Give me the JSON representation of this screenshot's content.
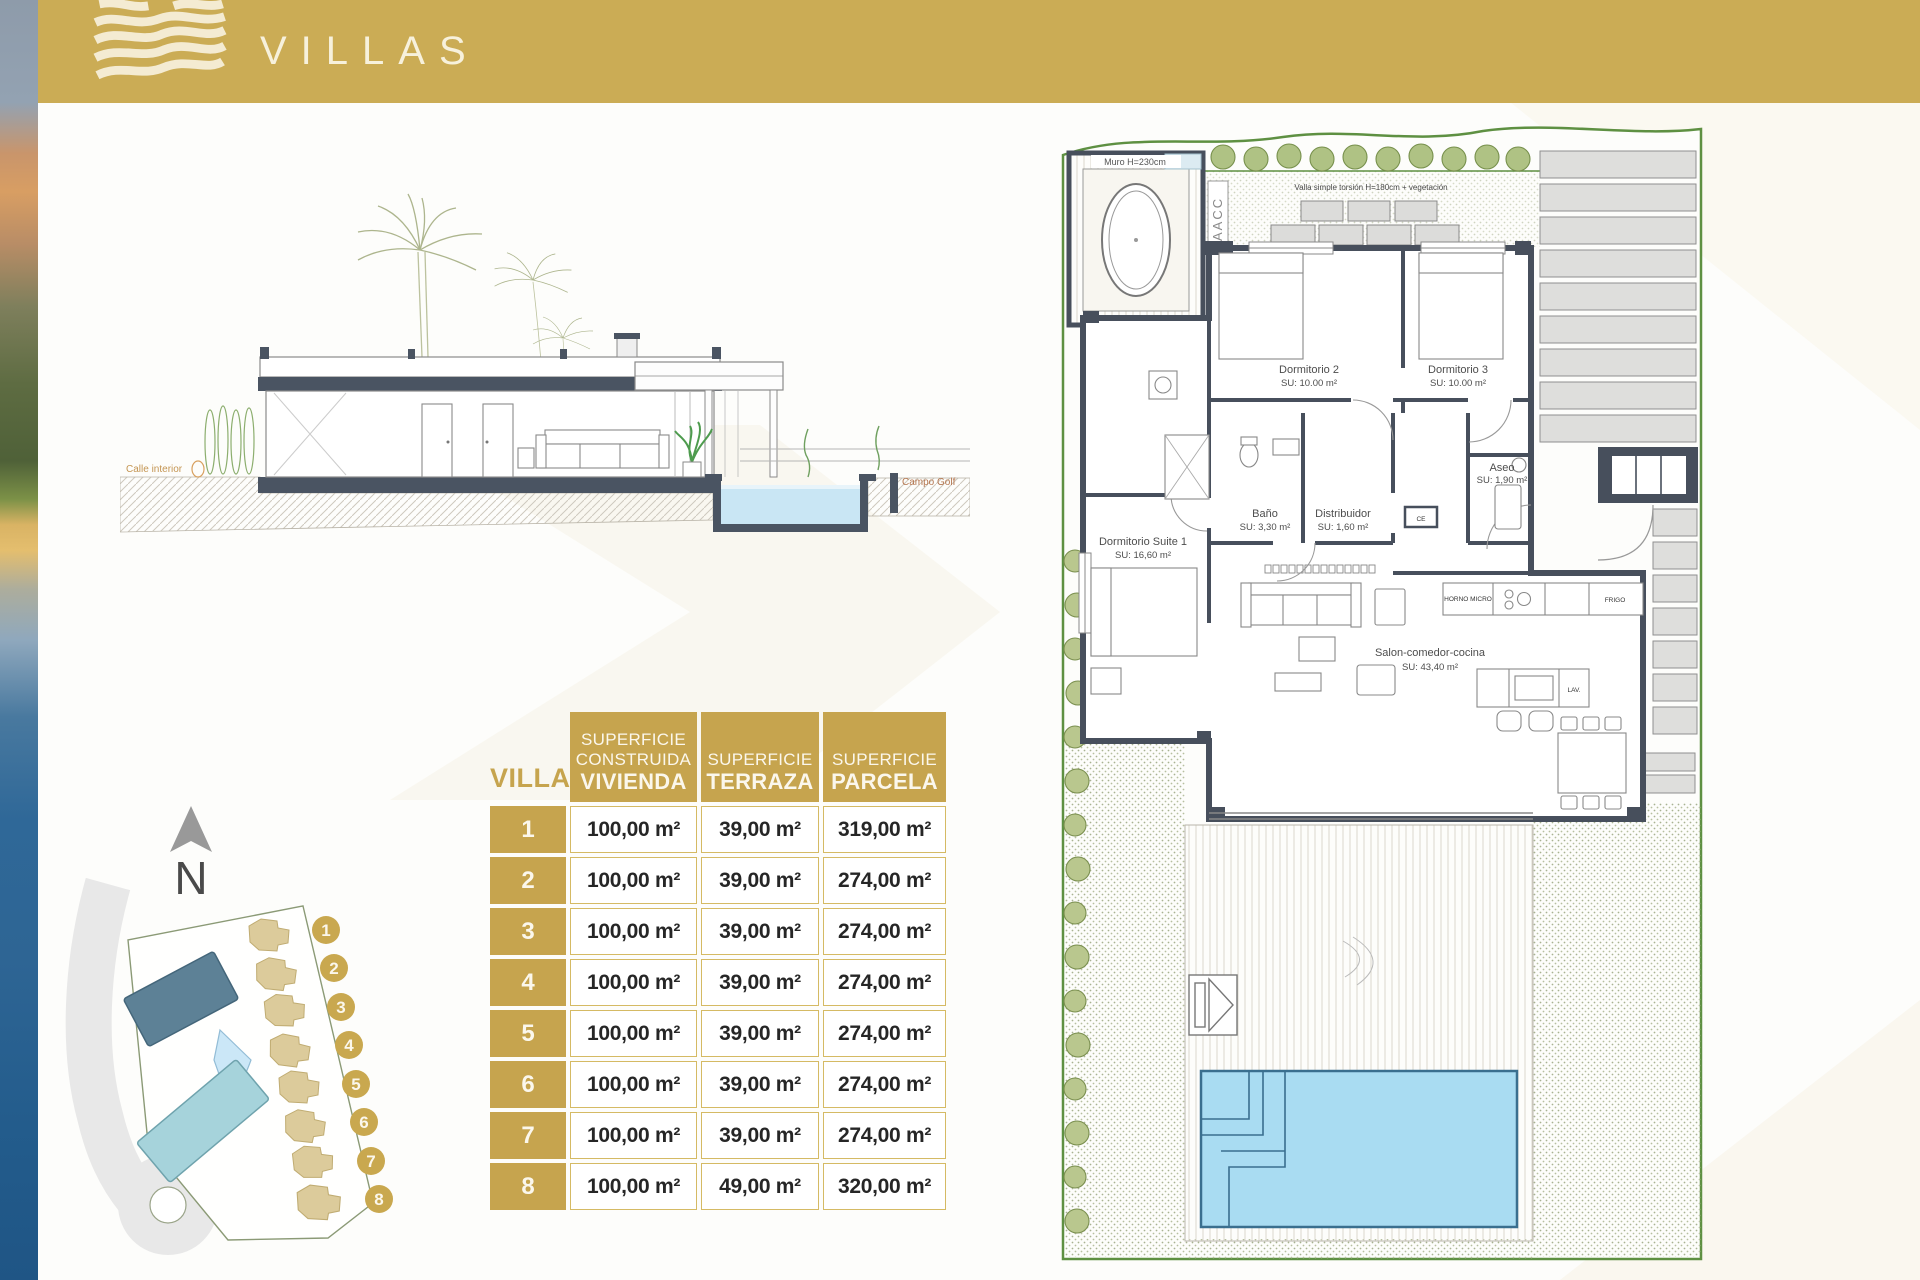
{
  "header": {
    "title": "VILLAS",
    "bar_color": "#CBAC55"
  },
  "section": {
    "label_street": "Calle interior",
    "label_golf": "Campo Golf"
  },
  "table": {
    "villa_col": "VILLA",
    "col1": [
      "SUPERFICIE",
      "CONSTRUIDA",
      "VIVIENDA"
    ],
    "col2": [
      "SUPERFICIE",
      "TERRAZA"
    ],
    "col3": [
      "SUPERFICIE",
      "PARCELA"
    ],
    "rows": [
      {
        "n": "1",
        "vivienda": "100,00 m²",
        "terraza": "39,00 m²",
        "parcela": "319,00 m²"
      },
      {
        "n": "2",
        "vivienda": "100,00 m²",
        "terraza": "39,00 m²",
        "parcela": "274,00 m²"
      },
      {
        "n": "3",
        "vivienda": "100,00 m²",
        "terraza": "39,00 m²",
        "parcela": "274,00 m²"
      },
      {
        "n": "4",
        "vivienda": "100,00 m²",
        "terraza": "39,00 m²",
        "parcela": "274,00 m²"
      },
      {
        "n": "5",
        "vivienda": "100,00 m²",
        "terraza": "39,00 m²",
        "parcela": "274,00 m²"
      },
      {
        "n": "6",
        "vivienda": "100,00 m²",
        "terraza": "39,00 m²",
        "parcela": "274,00 m²"
      },
      {
        "n": "7",
        "vivienda": "100,00 m²",
        "terraza": "39,00 m²",
        "parcela": "274,00 m²"
      },
      {
        "n": "8",
        "vivienda": "100,00 m²",
        "terraza": "49,00 m²",
        "parcela": "320,00 m²"
      }
    ]
  },
  "site_map": {
    "north": "N",
    "badges": [
      "1",
      "2",
      "3",
      "4",
      "5",
      "6",
      "7",
      "8"
    ]
  },
  "floor_plan": {
    "muro_note": "Muro H=230cm",
    "fence_note": "Valla simple torsión H=180cm + vegetación",
    "aacc": "AACC",
    "rooms": {
      "dorm2_name": "Dormitorio 2",
      "dorm2_area": "SU: 10.00 m²",
      "dorm3_name": "Dormitorio 3",
      "dorm3_area": "SU: 10.00 m²",
      "bano_name": "Baño",
      "bano_area": "SU: 3,30 m²",
      "distribuidor_name": "Distribuidor",
      "distribuidor_area": "SU: 1,60 m²",
      "aseo_name": "Aseo",
      "aseo_area": "SU: 1,90 m²",
      "suite_name": "Dormitorio Suite 1",
      "suite_area": "SU: 16,60 m²",
      "salon_name": "Salon-comedor-cocina",
      "salon_area": "SU: 43,40 m²"
    },
    "labels": {
      "horno": "HORNO MICRO",
      "frigo": "FRIGO",
      "lav": "LAV.",
      "ce": "CE"
    }
  },
  "colors": {
    "gold": "#C6A44E",
    "gold_bar": "#CBAC55",
    "cream": "#F4EBD2",
    "wall": "#474F5C",
    "pool": "#A9DCF2",
    "building_dark": "#5D8196",
    "building_teal": "#A6D3DB",
    "plot_green": "#5E9042"
  }
}
